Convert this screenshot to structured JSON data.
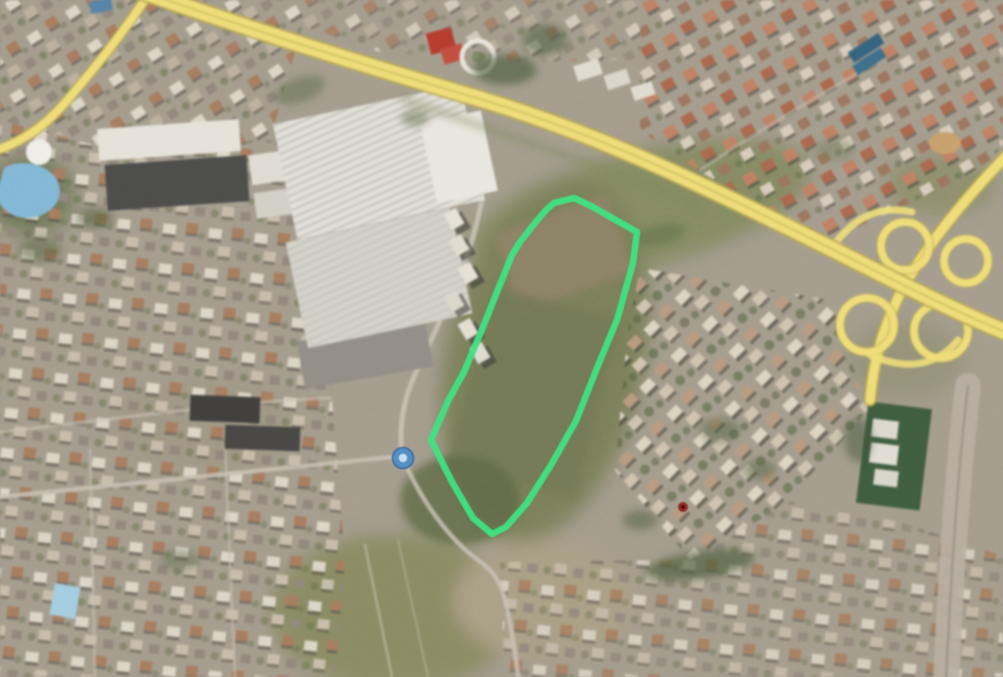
{
  "scene": {
    "base_color": "#9f9788",
    "haze_color": "#b9b2a4"
  },
  "parcel": {
    "outline_color": "#40e183",
    "outline_width": 6.5,
    "points": "554,203 574,198 591,206 637,232 633,263 617,320 599,363 576,421 551,465 527,503 506,527 492,534 473,518 452,482 436,450 431,440 448,401 464,372 481,332 497,292 512,255 520,242 535,223 546,210"
  },
  "markers": {
    "location_marker": {
      "transform": "translate(403,458)",
      "outer_fill": "#4f8fc9",
      "outer_r": 10.5,
      "ring_color": "#35679e",
      "inner_fill": "#c9dff0",
      "inner_r": 4.2
    },
    "red_dot": {
      "transform": "translate(683,507)",
      "fill": "#8f2721",
      "r": 5,
      "core_fill": "#4a0f0c",
      "core_r": 2
    }
  },
  "roads": {
    "highway_core": "#ecd96e",
    "highway_edge": "#b3a34c",
    "highway_median": "#c8b75a",
    "main_d": "M138,-10 C240,26 340,58 470,96 C590,131 690,178 830,248 C880,273 950,310 1013,335",
    "ramp_northwest_d": "M150,-8 C125,30 100,62 64,104 C40,131 18,143 -6,151",
    "cross_d": "M1012,150 C965,198 928,243 903,288 C884,325 874,357 870,400",
    "corridor_d": "M968,386 C959,460 952,555 946,680",
    "corridor_color": "#b2aa9c",
    "loop_nw": {
      "cx": 905,
      "cy": 246,
      "r": 24
    },
    "loop_sw": {
      "cx": 867,
      "cy": 325,
      "r": 27
    },
    "loop_se": {
      "cx": 941,
      "cy": 331,
      "r": 27
    },
    "loop_ne": {
      "cx": 966,
      "cy": 261,
      "r": 22
    },
    "ramp_outer_north_d": "M830,250 C855,215 880,205 912,212",
    "ramp_outer_south_d": "M870,355 C905,370 935,368 958,340",
    "street_color": "#c3bcae",
    "street_to_marker_d": "M0,497 C150,482 300,466 402,456",
    "street_west_of_parcel_d": "M402,456 C398,420 406,392 418,368 C436,330 450,300 466,258 C474,237 478,218 482,200",
    "street_south_d": "M402,456 C420,500 450,540 478,560 C492,570 500,580 505,600 C512,630 516,655 518,677",
    "street_grid_a_d": "M0,432 C110,420 230,402 330,398",
    "street_grid_b_d": "M90,450 L95,677",
    "street_grid_c_d": "M225,445 L235,677",
    "street_topright_d": "M700,170 C760,130 820,95 880,60"
  },
  "buildings": {
    "factory_main": {
      "x": 283,
      "y": 103,
      "width": 192,
      "height": 118,
      "transform": "rotate(-12 379 162)",
      "fill": "#dedbd4"
    },
    "factory_south": {
      "x": 295,
      "y": 224,
      "width": 168,
      "height": 108,
      "transform": "rotate(-12 379 278)",
      "fill": "#cfccc4"
    },
    "factory_annex": {
      "x": 428,
      "y": 116,
      "width": 62,
      "height": 82,
      "transform": "rotate(-12 459 157)",
      "fill": "#e6e3dc"
    },
    "warehouse_white": {
      "x": 98,
      "y": 124,
      "width": 142,
      "height": 32,
      "transform": "rotate(-4 169 140)",
      "fill": "#e2ded6"
    },
    "warehouse_dark": {
      "x": 106,
      "y": 160,
      "width": 142,
      "height": 46,
      "transform": "rotate(-4 177 183)",
      "fill": "#4a4a48"
    },
    "industrial_block_a": {
      "x": 250,
      "y": 152,
      "width": 48,
      "height": 30,
      "transform": "rotate(-8 274 167)",
      "fill": "#dcd8cf"
    },
    "industrial_block_b": {
      "x": 255,
      "y": 190,
      "width": 44,
      "height": 26,
      "transform": "rotate(-8 277 203)",
      "fill": "#cfcbc2"
    },
    "yard_south": {
      "x": 300,
      "y": 330,
      "width": 130,
      "height": 48,
      "transform": "rotate(-10 365 354)",
      "fill": "#8c8780"
    },
    "dark_slab_a": {
      "x": 190,
      "y": 396,
      "width": 70,
      "height": 26,
      "transform": "rotate(2 225 409)",
      "fill": "#3f3e3c"
    },
    "dark_slab_b": {
      "x": 225,
      "y": 426,
      "width": 75,
      "height": 24,
      "transform": "rotate(2 262 438)",
      "fill": "#464542"
    },
    "red_building_a": {
      "x": 428,
      "y": 30,
      "width": 26,
      "height": 22,
      "transform": "rotate(-15 441 41)",
      "fill": "#b53a2e"
    },
    "red_building_b": {
      "x": 442,
      "y": 46,
      "width": 22,
      "height": 16,
      "transform": "rotate(-15 453 54)",
      "fill": "#c24a3c"
    },
    "round_building": {
      "transform": "translate(39,152)",
      "r": 13,
      "fill": "#eceae4"
    },
    "white_ring": {
      "transform": "translate(478,57)",
      "r": 16,
      "stroke": "#e5e1d7"
    },
    "blue_roof_a": {
      "x": 848,
      "y": 42,
      "width": 36,
      "height": 12,
      "transform": "rotate(-33 866 48)",
      "fill": "#31607c"
    },
    "blue_roof_b": {
      "x": 852,
      "y": 56,
      "width": 34,
      "height": 11,
      "transform": "rotate(-33 869 61)",
      "fill": "#3a6b88"
    },
    "small_blue_roof": {
      "x": 90,
      "y": 0,
      "width": 22,
      "height": 12,
      "transform": "rotate(-10 101 6)",
      "fill": "#4f7ea6"
    },
    "green_compound": {
      "x": 862,
      "y": 405,
      "width": 64,
      "height": 102,
      "transform": "rotate(7 894 456)",
      "fill": "#3c5a3e"
    },
    "compound_block_a": {
      "x": 872,
      "y": 420,
      "width": 26,
      "height": 18,
      "transform": "rotate(7 885 429)",
      "fill": "#d9d5cb"
    },
    "compound_block_b": {
      "x": 870,
      "y": 444,
      "width": 28,
      "height": 20,
      "transform": "rotate(7 884 454)",
      "fill": "#ddd9d0"
    },
    "compound_block_c": {
      "x": 874,
      "y": 470,
      "width": 24,
      "height": 16,
      "transform": "rotate(7 886 478)",
      "fill": "#d5d1c7"
    }
  },
  "water": {
    "aquapark_lagoon_d": "M4,168 C20,158 50,164 58,182 C64,198 54,212 36,217 C18,221 2,213 -4,196 Z",
    "aquapark_fill": "#7ab3d4",
    "pool": {
      "x": 52,
      "y": 585,
      "width": 26,
      "height": 32,
      "transform": "rotate(10 65 601)",
      "fill": "#9ccadd"
    },
    "dirt_patch": {
      "cx": 945,
      "cy": 143,
      "rx": 16,
      "ry": 11,
      "fill": "#c59b66"
    }
  }
}
